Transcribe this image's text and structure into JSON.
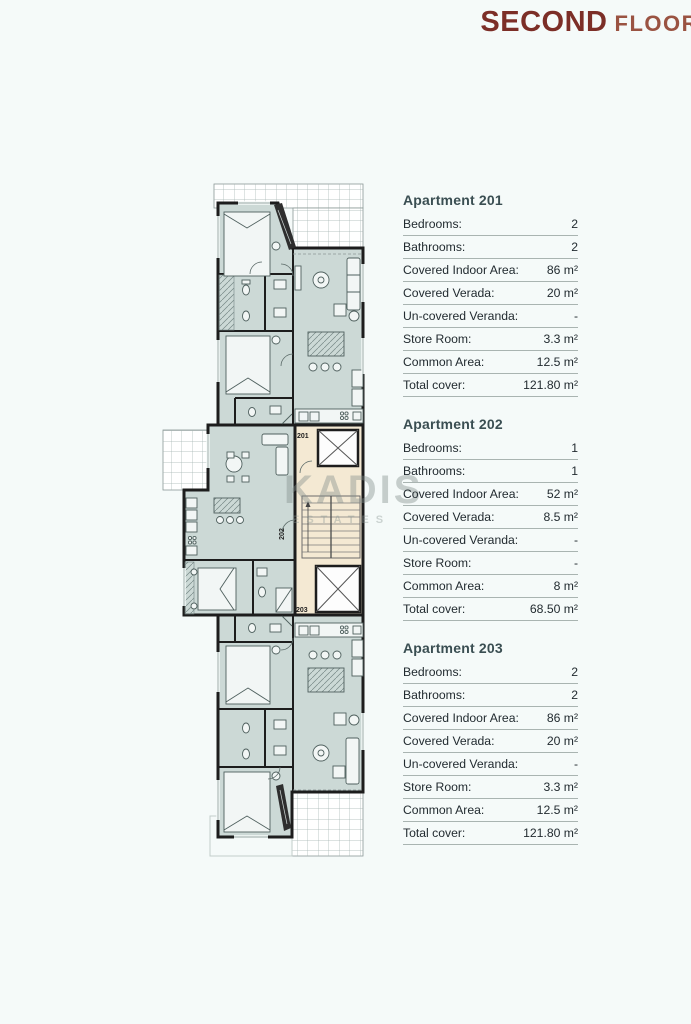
{
  "title": {
    "primary": "SECOND",
    "secondary": "FLOOR"
  },
  "watermark": {
    "name": "KADIS",
    "tagline": "ESTATES"
  },
  "plan": {
    "unit_labels": [
      "201",
      "202",
      "203"
    ]
  },
  "apartments": [
    {
      "heading": "Apartment 201",
      "rows": [
        {
          "label": "Bedrooms:",
          "value": "2"
        },
        {
          "label": "Bathrooms:",
          "value": "2"
        },
        {
          "label": "Covered Indoor Area:",
          "value": "86 m²"
        },
        {
          "label": "Covered Verada:",
          "value": "20 m²"
        },
        {
          "label": "Un-covered Veranda:",
          "value": "-"
        },
        {
          "label": "Store Room:",
          "value": "3.3 m²"
        },
        {
          "label": "Common Area:",
          "value": "12.5 m²"
        },
        {
          "label": "Total cover:",
          "value": "121.80 m²"
        }
      ]
    },
    {
      "heading": "Apartment 202",
      "rows": [
        {
          "label": "Bedrooms:",
          "value": "1"
        },
        {
          "label": "Bathrooms:",
          "value": "1"
        },
        {
          "label": "Covered Indoor Area:",
          "value": "52 m²"
        },
        {
          "label": "Covered Verada:",
          "value": "8.5 m²"
        },
        {
          "label": "Un-covered Veranda:",
          "value": "-"
        },
        {
          "label": "Store Room:",
          "value": "-"
        },
        {
          "label": "Common Area:",
          "value": "8 m²"
        },
        {
          "label": "Total cover:",
          "value": "68.50 m²"
        }
      ]
    },
    {
      "heading": "Apartment 203",
      "rows": [
        {
          "label": "Bedrooms:",
          "value": "2"
        },
        {
          "label": "Bathrooms:",
          "value": "2"
        },
        {
          "label": "Covered Indoor Area:",
          "value": "86 m²"
        },
        {
          "label": "Covered Verada:",
          "value": "20 m²"
        },
        {
          "label": "Un-covered Veranda:",
          "value": "-"
        },
        {
          "label": "Store Room:",
          "value": "3.3 m²"
        },
        {
          "label": "Common Area:",
          "value": "12.5 m²"
        },
        {
          "label": "Total cover:",
          "value": "121.80 m²"
        }
      ]
    }
  ]
}
